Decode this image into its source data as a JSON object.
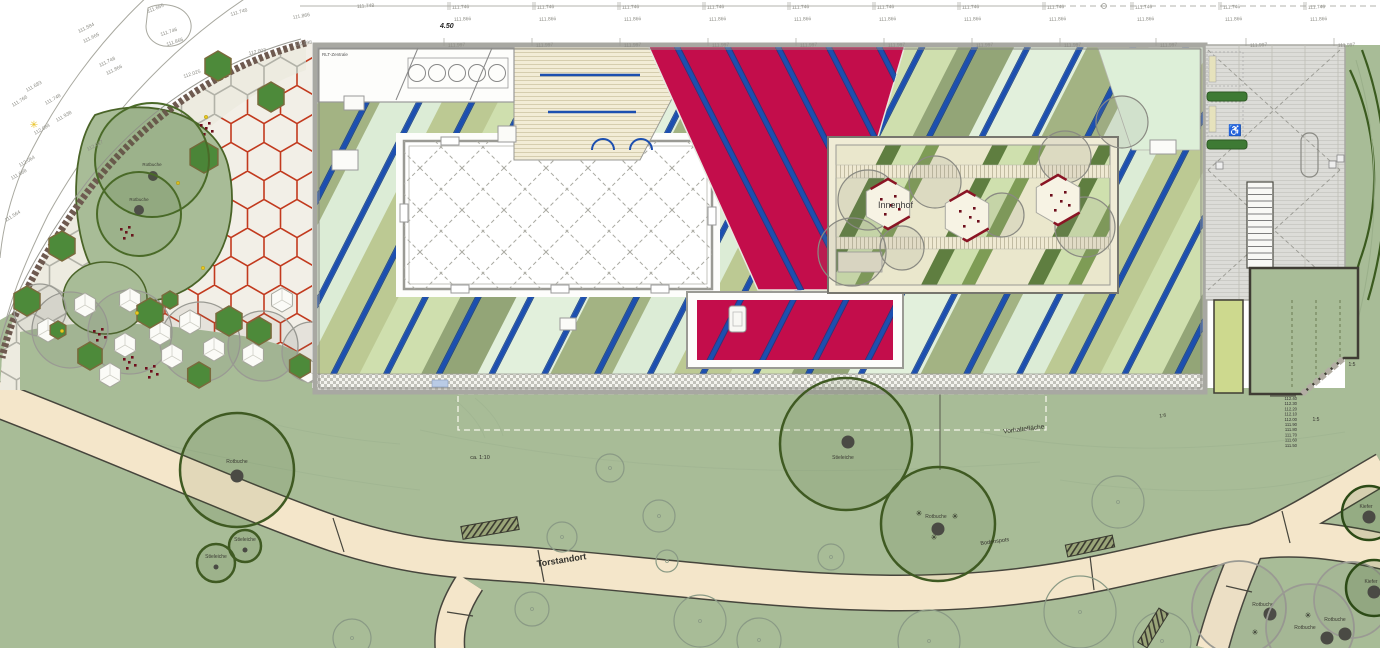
{
  "colors": {
    "park_green": "#a8bc97",
    "path_beige": "#f4e6ca",
    "path_edge": "#46453c",
    "plaza_base": "#f2efe7",
    "hex_joint_red": "#c23a1e",
    "hex_joint_gray": "#b2b2a8",
    "roof_blue": "#1c4fb0",
    "roof_red": "#c30d4b",
    "parapet_gray": "#a8a8a2",
    "yard_gray": "#dcdcd8",
    "hedge_green": "#3e7a34",
    "strip_yellowgreen": "#cdd98e",
    "tree_outline_dark": "#3f5a22",
    "tree_outline_gray": "#9a9a93",
    "chair_red": "#6e0e1c"
  },
  "survey": {
    "dim": {
      "t": "4.50",
      "x": 440,
      "y": 28
    },
    "rows": [
      {
        "label": "111.746",
        "y": 4,
        "xs": [
          452,
          537,
          622,
          707,
          792,
          877,
          962,
          1047,
          1135,
          1223,
          1308
        ]
      },
      {
        "label": "111.866",
        "y": 16,
        "xs": [
          454,
          539,
          624,
          709,
          794,
          879,
          964,
          1049,
          1137,
          1225,
          1310
        ]
      },
      {
        "label": "111.997",
        "y": 42,
        "xs": [
          448,
          536,
          624,
          712,
          800,
          888,
          976,
          1064,
          1160,
          1250,
          1338
        ]
      }
    ]
  },
  "road_labels": [
    {
      "t": "111.665",
      "x": 148,
      "y": 9,
      "r": -22
    },
    {
      "t": "111.746",
      "x": 231,
      "y": 12,
      "r": -16
    },
    {
      "t": "111.866",
      "x": 293,
      "y": 15,
      "r": -10
    },
    {
      "t": "111.748",
      "x": 357,
      "y": 4,
      "r": -4
    },
    {
      "t": "111.584",
      "x": 79,
      "y": 29,
      "r": -26
    },
    {
      "t": "111.665",
      "x": 84,
      "y": 39,
      "r": -26
    },
    {
      "t": "111.746",
      "x": 161,
      "y": 32,
      "r": -18
    },
    {
      "t": "111.866",
      "x": 167,
      "y": 42,
      "r": -18
    },
    {
      "t": "111.998",
      "x": 295,
      "y": 42,
      "r": -8
    },
    {
      "t": "112.003",
      "x": 249,
      "y": 51,
      "r": -12
    },
    {
      "t": "112.025",
      "x": 184,
      "y": 74,
      "r": -18
    },
    {
      "t": "111.748",
      "x": 100,
      "y": 63,
      "r": -26
    },
    {
      "t": "111.866",
      "x": 107,
      "y": 71,
      "r": -26
    },
    {
      "t": "111.683",
      "x": 27,
      "y": 88,
      "r": -30
    },
    {
      "t": "111.766",
      "x": 13,
      "y": 103,
      "r": -32
    },
    {
      "t": "111.748",
      "x": 46,
      "y": 101,
      "r": -30
    },
    {
      "t": "111.938",
      "x": 57,
      "y": 118,
      "r": -30
    },
    {
      "t": "112.017",
      "x": 88,
      "y": 147,
      "r": -28
    },
    {
      "t": "112.084",
      "x": 35,
      "y": 131,
      "r": -30
    },
    {
      "t": "112.064",
      "x": 20,
      "y": 163,
      "r": -30
    },
    {
      "t": "111.668",
      "x": 12,
      "y": 176,
      "r": -30
    },
    {
      "t": "111.564",
      "x": 6,
      "y": 218,
      "r": -32
    }
  ],
  "building": {
    "rlt_label": "RLT-Zentrale",
    "innenhof_label": "Innenhof"
  },
  "courtyard": {
    "pads": [
      {
        "x": 888,
        "y": 204
      },
      {
        "x": 967,
        "y": 216
      },
      {
        "x": 1058,
        "y": 200
      }
    ],
    "canopies": [
      [
        868,
        200,
        30
      ],
      [
        935,
        182,
        26
      ],
      [
        1002,
        215,
        22
      ],
      [
        1085,
        227,
        30
      ],
      [
        1065,
        157,
        26
      ],
      [
        902,
        248,
        22
      ],
      [
        1122,
        122,
        26
      ],
      [
        852,
        252,
        34
      ]
    ]
  },
  "plaza": {
    "green_hexes": [
      [
        218,
        66,
        15
      ],
      [
        271,
        97,
        15
      ],
      [
        204,
        157,
        16
      ],
      [
        62,
        246,
        15
      ],
      [
        27,
        301,
        15
      ],
      [
        150,
        313,
        15
      ],
      [
        229,
        321,
        15
      ],
      [
        90,
        356,
        14
      ],
      [
        259,
        331,
        14
      ],
      [
        199,
        375,
        13
      ],
      [
        300,
        366,
        12
      ],
      [
        170,
        300,
        9
      ],
      [
        58,
        330,
        9
      ]
    ],
    "white_hexes": [
      [
        48,
        330
      ],
      [
        85,
        305
      ],
      [
        125,
        345
      ],
      [
        172,
        356
      ],
      [
        214,
        349
      ],
      [
        253,
        355
      ],
      [
        110,
        375
      ],
      [
        160,
        333
      ],
      [
        308,
        371
      ],
      [
        282,
        300
      ],
      [
        130,
        300
      ],
      [
        190,
        322
      ]
    ],
    "canopies": [
      [
        70,
        330,
        38
      ],
      [
        130,
        332,
        42
      ],
      [
        200,
        342,
        40
      ],
      [
        263,
        346,
        35
      ],
      [
        312,
        352,
        30
      ],
      [
        40,
        310,
        26
      ]
    ],
    "chair_clusters": [
      [
        205,
        128
      ],
      [
        125,
        232
      ],
      [
        98,
        334
      ],
      [
        128,
        362
      ],
      [
        150,
        371
      ]
    ],
    "yellow_dots": [
      [
        178,
        183
      ],
      [
        203,
        268
      ],
      [
        137,
        313
      ],
      [
        62,
        331
      ],
      [
        206,
        117
      ]
    ],
    "trees": [
      {
        "cx": 152,
        "cy": 160,
        "r": 57,
        "t": "Rotbuche",
        "lx": 152,
        "ly": 166,
        "dx": 153,
        "dy": 176
      },
      {
        "cx": 139,
        "cy": 214,
        "r": 42,
        "t": "Rotbuche",
        "lx": 139,
        "ly": 201,
        "dx": 139,
        "dy": 210
      }
    ],
    "star": {
      "x": 34,
      "y": 128
    }
  },
  "park": {
    "trees": [
      {
        "cx": 237,
        "cy": 470,
        "r": 57,
        "kind": "dark",
        "t": "Rotbuche",
        "lx": 237,
        "ly": 463,
        "dx": 237,
        "dy": 476
      },
      {
        "cx": 846,
        "cy": 444,
        "r": 66,
        "kind": "dark",
        "t": "Stieleiche",
        "lx": 843,
        "ly": 459,
        "dx": 848,
        "dy": 442
      },
      {
        "cx": 938,
        "cy": 524,
        "r": 57,
        "kind": "dark",
        "t": "Rotbuche",
        "lx": 936,
        "ly": 518,
        "dx": 938,
        "dy": 529
      },
      {
        "cx": 245,
        "cy": 546,
        "r": 16,
        "kind": "dark",
        "t": "Stieleiche",
        "lx": 245,
        "ly": 541,
        "dx": 245,
        "dy": 550
      },
      {
        "cx": 216,
        "cy": 563,
        "r": 19,
        "kind": "dark",
        "t": "Stieleiche",
        "lx": 216,
        "ly": 558,
        "dx": 216,
        "dy": 567
      },
      {
        "cx": 1239,
        "cy": 608,
        "r": 47,
        "kind": "gray",
        "t": "Rotbuche",
        "lx": 1263,
        "ly": 606,
        "dx": 1270,
        "dy": 614
      },
      {
        "cx": 1310,
        "cy": 628,
        "r": 44,
        "kind": "gray",
        "t": "Rotbuche",
        "lx": 1305,
        "ly": 629,
        "dx": 1327,
        "dy": 638
      },
      {
        "cx": 1352,
        "cy": 600,
        "r": 38,
        "kind": "gray",
        "t": "Rotbuche",
        "lx": 1335,
        "ly": 621,
        "dx": 1345,
        "dy": 634
      },
      {
        "cx": 1369,
        "cy": 513,
        "r": 27,
        "kind": "pine",
        "t": "Kiefer",
        "lx": 1366,
        "ly": 508,
        "dx": 1369,
        "dy": 517
      },
      {
        "cx": 1374,
        "cy": 588,
        "r": 28,
        "kind": "pine",
        "t": "Kiefer",
        "lx": 1371,
        "ly": 583,
        "dx": 1374,
        "dy": 592
      }
    ],
    "thin_trees": [
      [
        610,
        468,
        14
      ],
      [
        659,
        516,
        16
      ],
      [
        700,
        621,
        26
      ],
      [
        759,
        640,
        22
      ],
      [
        831,
        557,
        13
      ],
      [
        929,
        641,
        31
      ],
      [
        1118,
        502,
        26
      ],
      [
        1162,
        641,
        29
      ],
      [
        532,
        609,
        17
      ],
      [
        667,
        561,
        11
      ],
      [
        1080,
        612,
        36
      ],
      [
        352,
        638,
        19
      ],
      [
        562,
        537,
        15
      ]
    ],
    "benches": [
      [
        490,
        528,
        57,
        13,
        -10
      ],
      [
        1090,
        546,
        48,
        12,
        -12
      ],
      [
        1153,
        628,
        40,
        11,
        -58
      ]
    ],
    "spots": [
      [
        919,
        513
      ],
      [
        955,
        516
      ],
      [
        934,
        537
      ],
      [
        1255,
        632
      ],
      [
        1308,
        615
      ]
    ],
    "labels": [
      {
        "t": "Torstandort",
        "x": 562,
        "y": 563,
        "s": 9,
        "r": -9,
        "b": 1
      },
      {
        "t": "Vorhaltefläche",
        "x": 1024,
        "y": 431,
        "s": 6.5,
        "r": -7,
        "b": 0
      },
      {
        "t": "ca. 1:10",
        "x": 480,
        "y": 459,
        "s": 5.5,
        "r": 0,
        "b": 0
      },
      {
        "t": "1:6",
        "x": 1163,
        "y": 417,
        "s": 5,
        "r": -8,
        "b": 0
      },
      {
        "t": "1:5",
        "x": 1316,
        "y": 421,
        "s": 5,
        "r": 0,
        "b": 0
      },
      {
        "t": "1:5",
        "x": 1352,
        "y": 366,
        "s": 5,
        "r": 0,
        "b": 0
      },
      {
        "t": "Bodenspots",
        "x": 995,
        "y": 543,
        "s": 5.5,
        "r": -8,
        "b": 0
      }
    ],
    "elevation": {
      "x": 1297,
      "y": 400,
      "values": [
        "112.40",
        "112.30",
        "112.20",
        "112.10",
        "112.00",
        "111.90",
        "111.80",
        "111.70",
        "111.60",
        "111.50"
      ]
    }
  }
}
